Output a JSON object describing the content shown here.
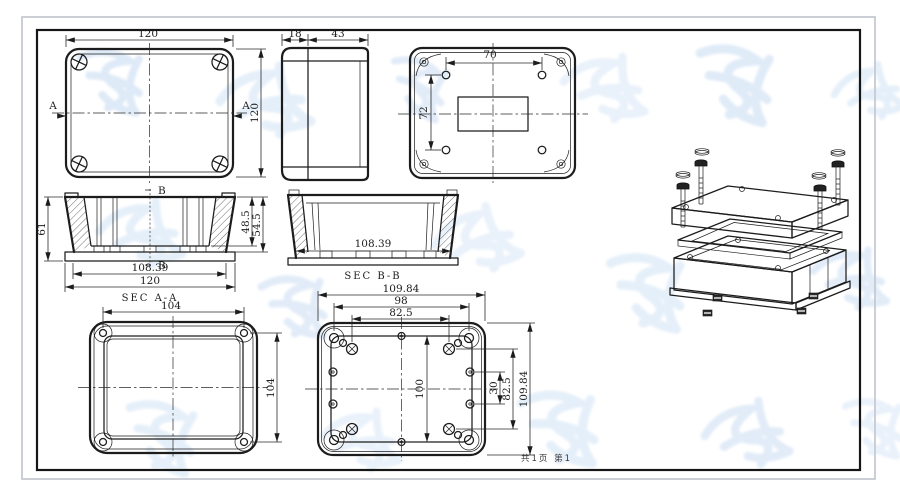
{
  "page": {
    "footer_page_info": "共1页 第1"
  },
  "colors": {
    "line": "#1c1c1c",
    "frame_inner": "#161616",
    "frame_outer": "#c6cad2",
    "watermark": "#dbe8f7",
    "paper": "#ffffff"
  },
  "views": {
    "cover_front": {
      "dim_width": "120",
      "dim_height": "120",
      "section_mark_left": "A",
      "section_mark_right": "A"
    },
    "side": {
      "dim_lid_thickness": "18",
      "dim_body_depth": "43"
    },
    "back": {
      "dim_hole_spacing_x": "70",
      "dim_hole_spacing_y": "72"
    },
    "sec_aa": {
      "label": "SEC A-A",
      "dim_total_height": "61",
      "dim_inner_depth": "48.5",
      "dim_outer_depth": "54.5",
      "dim_inner_width": "108.39",
      "dim_outer_width": "120",
      "section_mark_top": "B",
      "section_mark_bottom": "B"
    },
    "sec_bb": {
      "label": "SEC B-B",
      "dim_inner_width": "108.39"
    },
    "cover_inside": {
      "dim_width": "104",
      "dim_height": "104"
    },
    "base_inside": {
      "dim_overall_width": "109.84",
      "dim_hole_width": "98",
      "dim_boss_width": "82.5",
      "dim_overall_height": "109.84",
      "dim_boss_height": "82.5",
      "dim_side_hole_spacing": "30",
      "dim_center_spacing": "100"
    }
  }
}
